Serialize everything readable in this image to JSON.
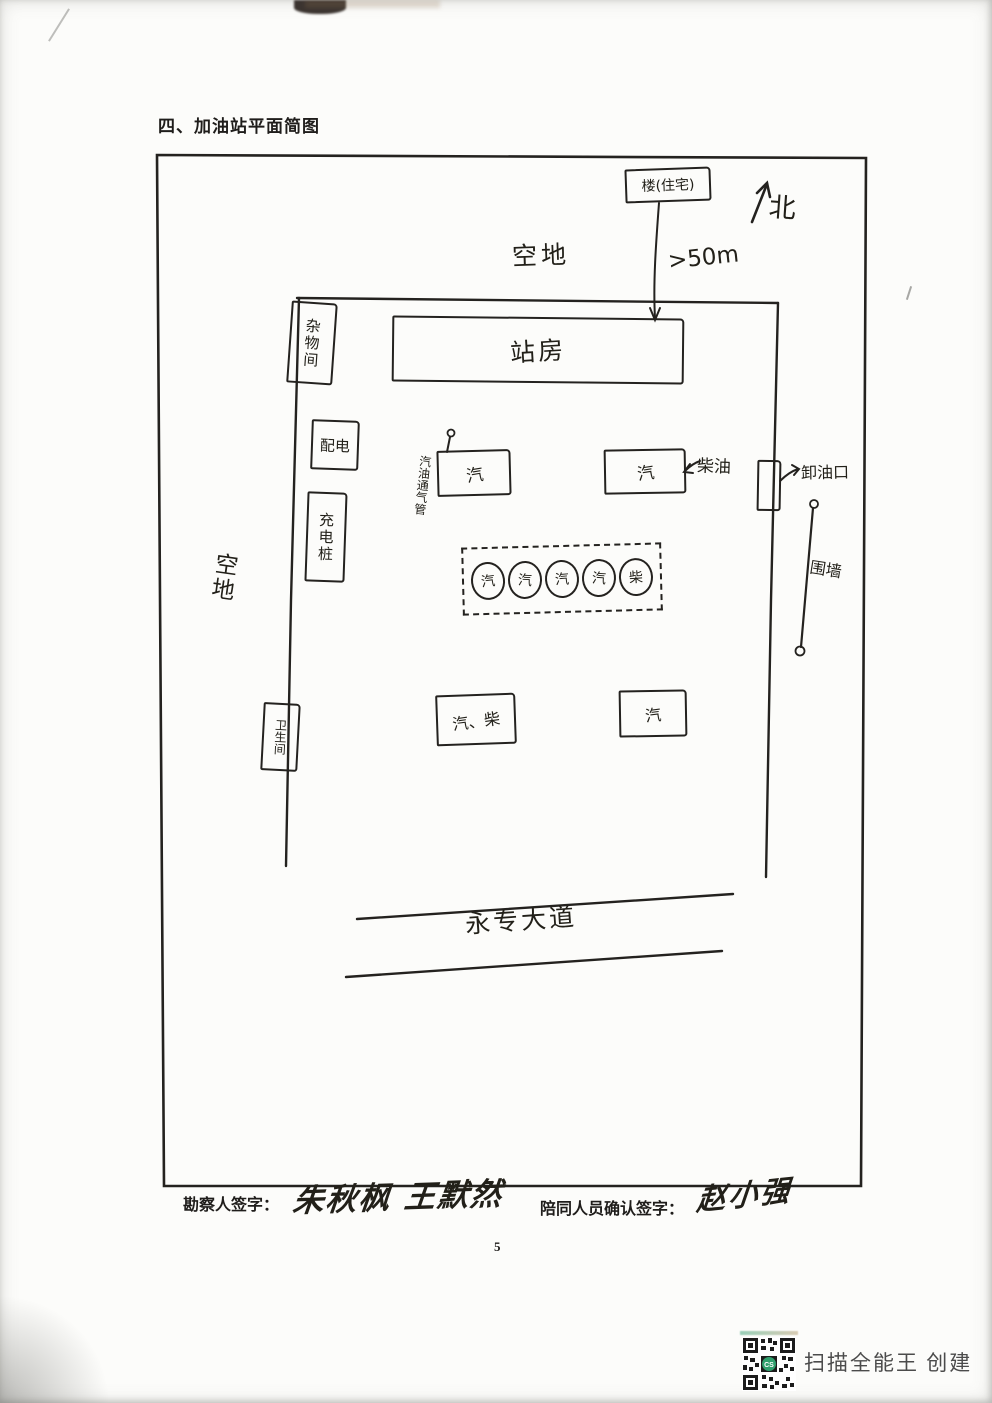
{
  "page": {
    "title": "四、加油站平面简图",
    "page_number": "5",
    "scanner_credit": "扫描全能王 创建"
  },
  "diagram": {
    "north_label": "北",
    "outside": {
      "building_label": "楼(住宅)",
      "distance_label": ">50m",
      "open_space_top": "空地",
      "open_space_left": "空地",
      "road_label": "永专大道"
    },
    "facilities": {
      "station_house": "站房",
      "storage_room": "杂物间",
      "power_room": "配电",
      "charging_pile": "充电桩",
      "restroom": "卫生间",
      "unloading_port": "卸油口",
      "vent_pipe": "汽油通气管",
      "diesel_label": "柴油",
      "wall_label": "围墙",
      "tank_upper_left": "汽",
      "tank_upper_right": "汽",
      "tank_lower_left": "汽、柴",
      "tank_lower_right": "汽"
    },
    "dispensers": [
      "汽",
      "汽",
      "汽",
      "汽",
      "柴"
    ]
  },
  "signatures": {
    "surveyor_label": "勘察人签字：",
    "surveyor_signature": "朱秋枫 王默然",
    "companion_label": "陪同人员确认签字：",
    "companion_signature": "赵小强"
  },
  "colors": {
    "ink": "#24221f",
    "qr_accent": "#2fa06d"
  }
}
